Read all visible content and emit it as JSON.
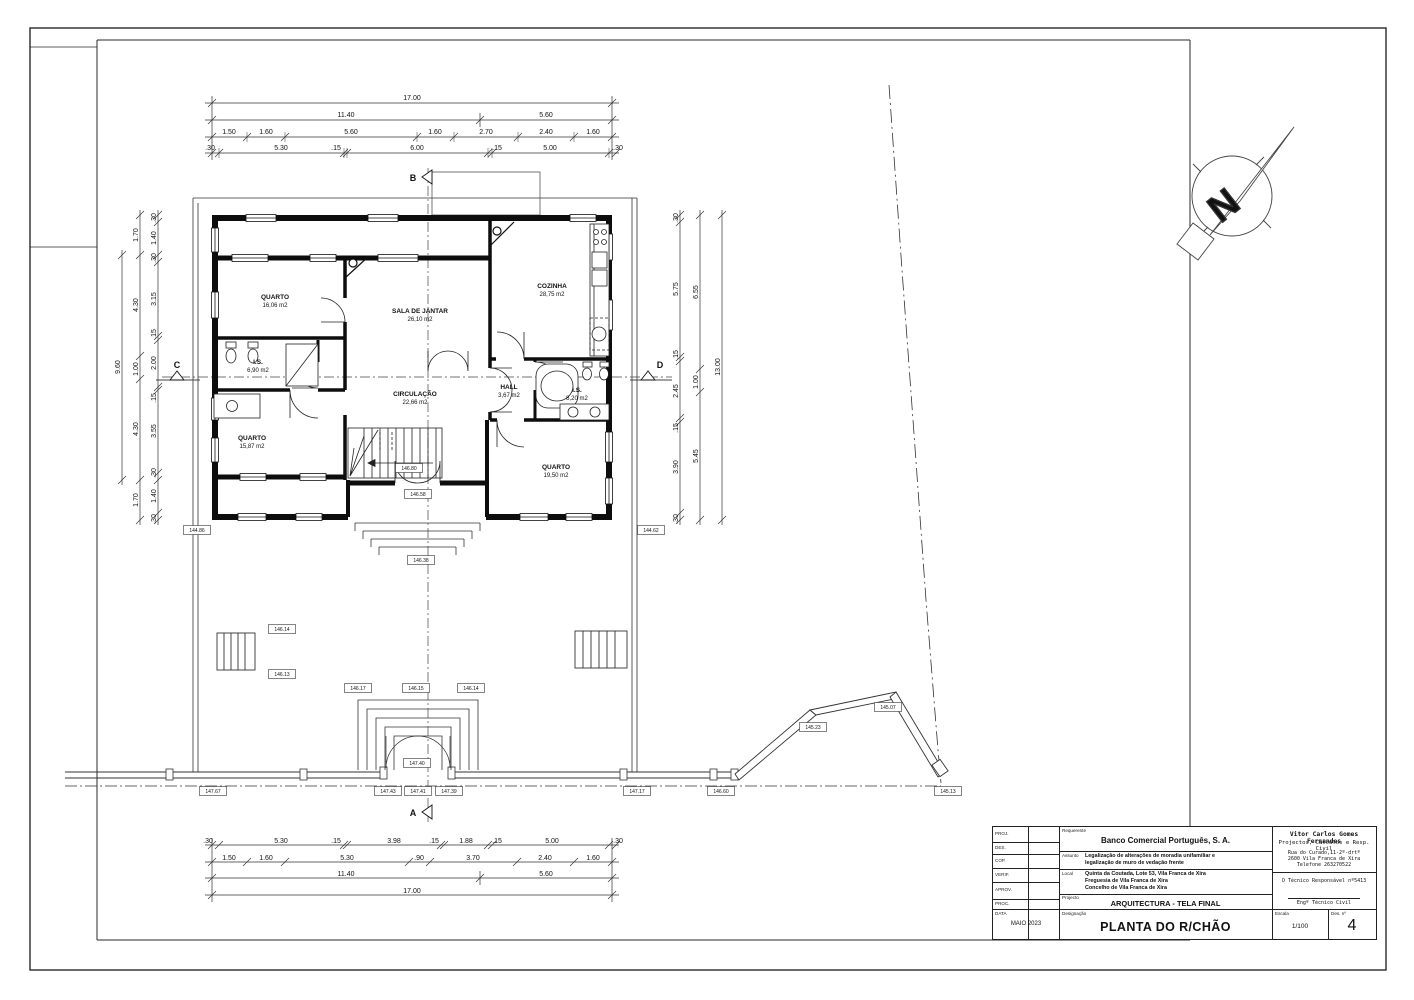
{
  "titleblock": {
    "rows_left": [
      "PROJ.",
      "DES.",
      "COP.",
      "VERIF.",
      "APROV.",
      "PROC."
    ],
    "data_label": "DATA",
    "date": "MAIO 2023",
    "requerente_label": "Requerente",
    "requerente": "Banco Comercial Português, S. A.",
    "assunto_label": "Assunto",
    "assunto1": "Legalização de alterações de moradia unifamiliar e",
    "assunto2": "legalização de muro de vedação frente",
    "local_label": "Local",
    "local1": "Quinta da Coutada, Lote 53, Vila Franca de Xira",
    "local2": "Freguesia de Vila Franca de Xira",
    "local3": "Concelho de Vila Franca de Xira",
    "projecto_label": "Projecto",
    "projecto": "ARQUITECTURA  -  TELA FINAL",
    "designacao_label": "Designação",
    "designacao": "PLANTA DO R/CHÃO",
    "escala_label": "Escala",
    "escala": "1/100",
    "desno_label": "Des. nº",
    "desno": "4",
    "autor1": "Vitor Carlos Gomes Fernandes",
    "autor2": "Projectos, Cálculos e Resp. Civil",
    "morada1": "Rua do Curado,11-2º-drtº",
    "morada2": "2600 Vila Franca de Xira",
    "morada3": "Telefone 263270522",
    "tecnico": "O Técnico Responsável nº5413",
    "tecnico2": "Engº Técnico Civil"
  },
  "plan": {
    "rooms": [
      {
        "name": "QUARTO",
        "area": "16,06 m2"
      },
      {
        "name": "SALA DE JANTAR",
        "area": "26,10 m2"
      },
      {
        "name": "COZINHA",
        "area": "28,75 m2"
      },
      {
        "name": "I.S.",
        "area": "6,90 m2"
      },
      {
        "name": "CIRCULAÇÃO",
        "area": "22,66 m2"
      },
      {
        "name": "HALL",
        "area": "3,67 m2"
      },
      {
        "name": "I.S.",
        "area": "8,20 m2"
      },
      {
        "name": "QUARTO",
        "area": "15,87 m2"
      },
      {
        "name": "QUARTO",
        "area": "19,50 m2"
      }
    ],
    "markers": {
      "a": "A",
      "b": "B",
      "c": "C",
      "d": "D",
      "north": "N"
    },
    "levels": [
      "146.17",
      "146.15",
      "146.14",
      "147.40",
      "147.43",
      "147.41",
      "147.39",
      "147.67",
      "147.17",
      "146.60",
      "145.23",
      "145.07",
      "145.13",
      "146.14",
      "146.13",
      "144.86",
      "144.62",
      "146.80",
      "146.58",
      "146.38"
    ]
  },
  "dims": {
    "top": [
      [
        "17.00"
      ],
      [
        "11.40",
        "5.60"
      ],
      [
        "1.50",
        "1.60",
        "5.60",
        "1.60",
        "2.70",
        "2.40",
        "1.60"
      ],
      [
        ".30",
        "5.30",
        ".15",
        "6.00",
        ".15",
        "5.00",
        ".30"
      ]
    ],
    "bottom": [
      [
        ".30",
        "5.30",
        ".15",
        "3.98",
        ".15",
        "1.88",
        ".15",
        "5.00",
        ".30"
      ],
      [
        "1.50",
        "1.60",
        "5.30",
        ".90",
        "3.70",
        "2.40",
        "1.60"
      ],
      [
        "11.40",
        "5.60"
      ],
      [
        "17.00"
      ]
    ],
    "left": {
      "outer": [
        "9.60"
      ],
      "mid": [
        "1.70",
        "4.30",
        "1.00",
        "4.30",
        "1.70"
      ],
      "inner": [
        ".30",
        "1.40",
        ".30",
        "3.15",
        ".15",
        "2.00",
        ".15",
        "3.55",
        ".30",
        "1.40",
        ".30"
      ]
    },
    "right": {
      "inner": [
        ".30",
        "5.75",
        ".15",
        "2.45",
        ".15",
        "3.90",
        ".30"
      ],
      "mid": [
        "6.55",
        "1.00",
        "5.45"
      ],
      "outer": [
        "13.00"
      ]
    }
  }
}
